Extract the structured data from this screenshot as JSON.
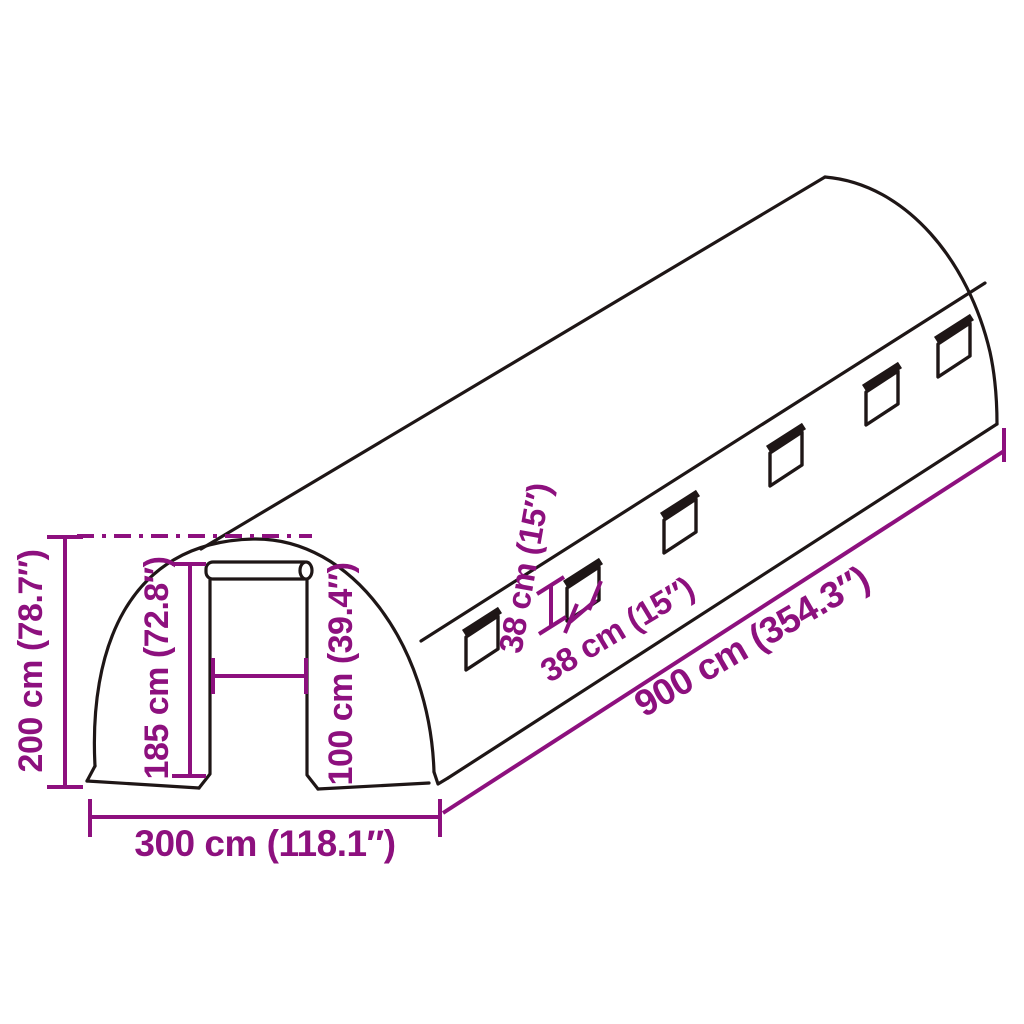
{
  "diagram": {
    "title": "polytunnel-greenhouse-dimension-diagram",
    "colors": {
      "dimension": "#8d107e",
      "outline": "#1e1616",
      "background": "#ffffff"
    },
    "labels": {
      "total_height": "200 cm (78.7″)",
      "door_height": "185 cm (72.8″)",
      "door_width": "100 cm (39.4″)",
      "base_width": "300 cm (118.1″)",
      "tunnel_length": "900 cm (354.3″)",
      "window_height": "38 cm (15″)",
      "window_width": "38 cm (15″)"
    },
    "window_count": 6
  }
}
